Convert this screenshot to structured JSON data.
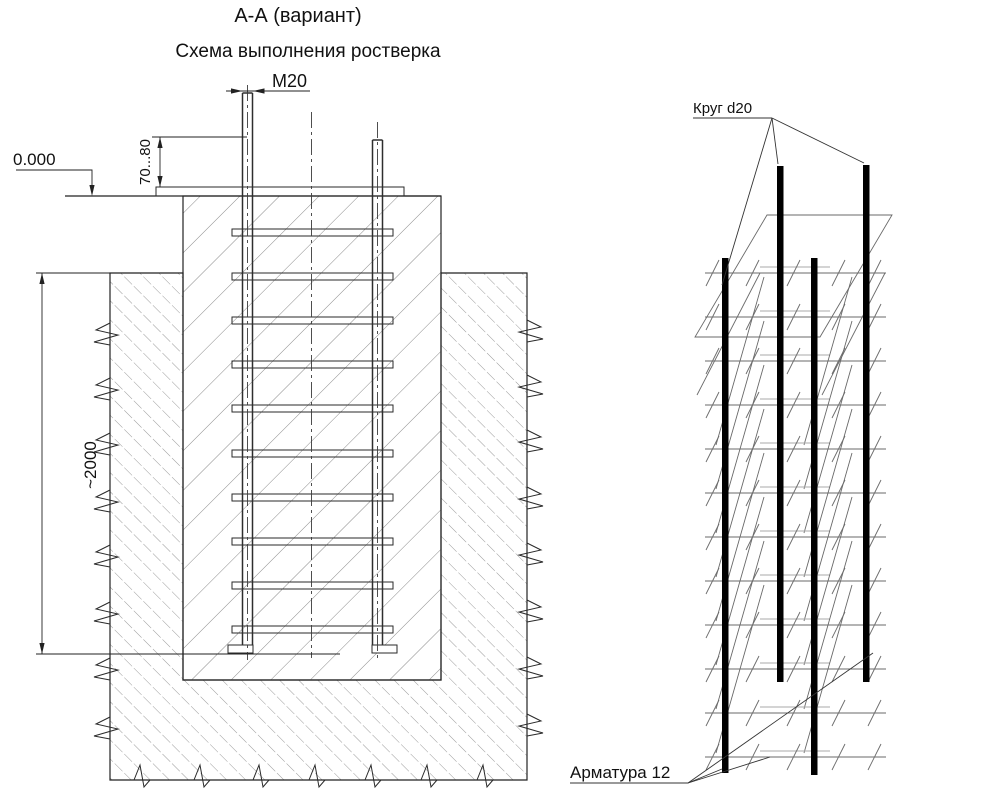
{
  "titles": {
    "section": "А-А (вариант)",
    "scheme": "Схема выполнения ростверка"
  },
  "dimensions": {
    "anchor_thread": "М20",
    "zero_level": "0.000",
    "protrusion": "70...80",
    "depth": "~2000"
  },
  "callouts": {
    "circle": "Круг d20",
    "rebar": "Арматура 12"
  }
}
